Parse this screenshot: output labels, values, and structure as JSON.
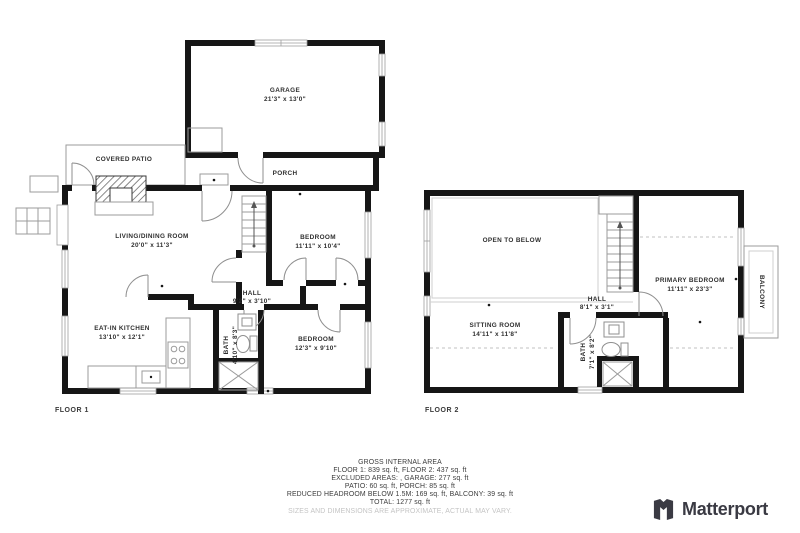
{
  "floor1": {
    "label": "FLOOR 1",
    "garage": {
      "name": "GARAGE",
      "dims": "21'3\" x 13'0\""
    },
    "covered_patio": {
      "name": "COVERED PATIO"
    },
    "porch": {
      "name": "PORCH"
    },
    "living_dining": {
      "name": "LIVING/DINING ROOM",
      "dims": "20'0\" x 11'3\""
    },
    "bedroom1": {
      "name": "BEDROOM",
      "dims": "11'11\" x 10'4\""
    },
    "hall": {
      "name": "HALL",
      "dims": "9'2\" x 3'10\""
    },
    "kitchen": {
      "name": "EAT-IN KITCHEN",
      "dims": "13'10\" x 12'1\""
    },
    "bath": {
      "name": "BATH",
      "dims": "4'10\" x 8'3\""
    },
    "bedroom2": {
      "name": "BEDROOM",
      "dims": "12'3\" x 9'10\""
    }
  },
  "floor2": {
    "label": "FLOOR 2",
    "open_to_below": {
      "name": "OPEN TO BELOW"
    },
    "primary_bedroom": {
      "name": "PRIMARY BEDROOM",
      "dims": "11'11\" x 23'3\""
    },
    "balcony": {
      "name": "BALCONY"
    },
    "hall": {
      "name": "HALL",
      "dims": "8'1\" x 3'1\""
    },
    "sitting_room": {
      "name": "SITTING ROOM",
      "dims": "14'11\" x 11'8\""
    },
    "bath": {
      "name": "BATH",
      "dims": "7'1\" x 8'2\""
    }
  },
  "footer": {
    "lines": [
      "GROSS INTERNAL AREA",
      "FLOOR 1: 839 sq. ft, FLOOR 2: 437 sq. ft",
      "EXCLUDED AREAS: , GARAGE: 277 sq. ft",
      "PATIO: 60 sq. ft, PORCH: 85 sq. ft",
      "REDUCED HEADROOM BELOW 1.5M: 169 sq. ft, BALCONY: 39 sq. ft",
      "TOTAL: 1277 sq. ft"
    ],
    "disclaimer": "SIZES AND DIMENSIONS ARE APPROXIMATE, ACTUAL MAY VARY."
  },
  "branding": {
    "name": "Matterport"
  },
  "colors": {
    "wall": "#161616",
    "thin_line": "#9b9b9b",
    "label_text": "#2f2f2f",
    "muted_text": "#c4c4c4",
    "logo": "#3a3a43"
  }
}
